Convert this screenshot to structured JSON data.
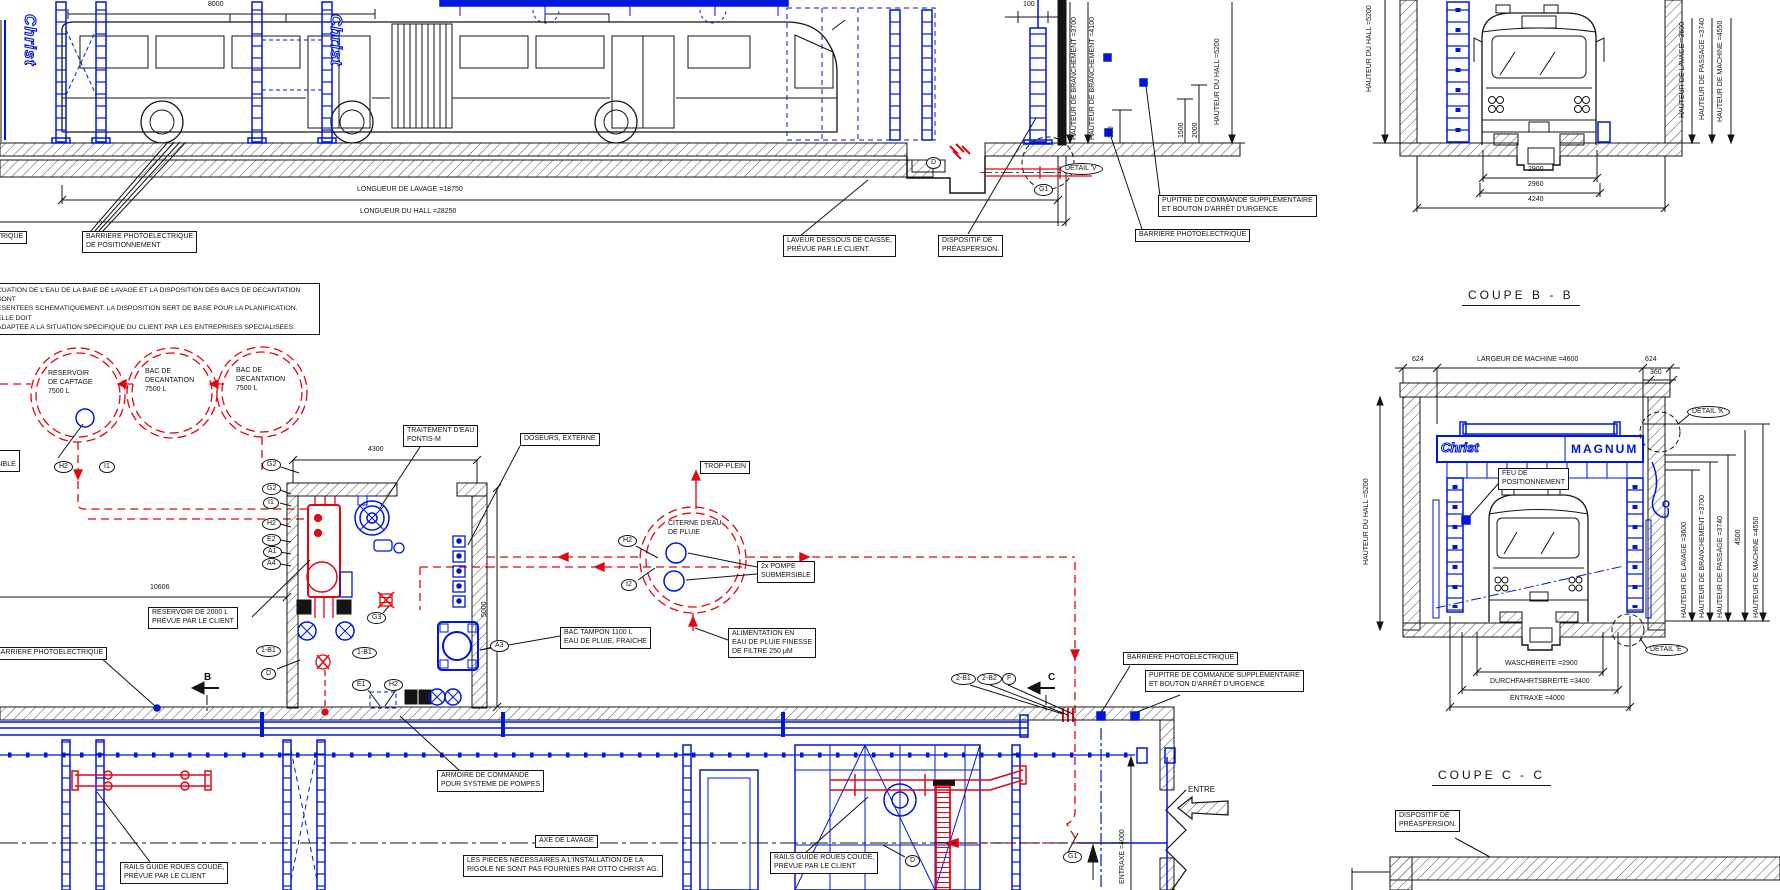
{
  "colors": {
    "blue": "#0016d9",
    "red": "#e30613",
    "black": "#141414"
  },
  "brand": {
    "christ": "Christ",
    "magnum": "MAGNUM"
  },
  "mk": {
    "h2": "H2",
    "i1": "I1",
    "i2": "I2",
    "g1": "G1",
    "g2": "G2",
    "g3": "G3",
    "e1": "E1",
    "e2": "E2",
    "a1": "A1",
    "a3": "A3",
    "a4": "A4",
    "d": "D",
    "f": "F",
    "b1": "1-B1",
    "b21": "2-B1",
    "b22": "2-B2",
    "b": "B",
    "c": "C"
  },
  "elevation": {
    "dim_8000": "8000",
    "dim_100": "100",
    "dim_300": "300",
    "dim_1500": "1500",
    "dim_2000": "2000",
    "longueur_lavage": "LONGUEUR DE LAVAGE =18750",
    "longueur_hall": "LONGUEUR DU HALL =28250",
    "h_branch_3700": "HAUTEUR DE BRANCHEMENT =3700",
    "h_branch_4100": "HAUTEUR DE BRANCHEMENT =4100",
    "h_hall_5200": "HAUTEUR DU HALL =5200",
    "detail_v": "DETAIL 'V'",
    "barriere_cut": "RE PHOTOELECTRIQUE",
    "barriere_pos": "BARRIERE PHOTOELECTRIQUE\nDE POSITIONNEMENT",
    "laveur": "LAVEUR DESSOUS DE CAISSE,\nPRÉVUE PAR LE CLIENT.",
    "preaspersion": "DISPOSITIF DE\nPRÉASPERSION.",
    "barriere": "BARRIERE PHOTOELECTRIQUE",
    "pupitre": "PUPITRE DE COMMANDE SUPPLÉMENTAIRE\nET BOUTON D'ARRÊT D'URGENCE"
  },
  "coupe_b": {
    "title": "COUPE B - B",
    "h_hall": "HAUTEUR DU HALL =5200",
    "h_lavage": "HAUTEUR DE LAVAGE =3600",
    "h_passage": "HAUTEUR DE PASSAGE =3740",
    "h_machine": "HAUTEUR DE MACHINE =4550",
    "d2900": "2900",
    "d2960": "2960",
    "d4240": "4240"
  },
  "coupe_c": {
    "title": "COUPE C - C",
    "d624": "624",
    "d360": "360",
    "d4500": "4500",
    "largeur": "LARGEUR DE MACHINE =4600",
    "h_hall": "HAUTEUR DU HALL =5200",
    "h_lavage": "HAUTEUR DE LAVAGE =3600",
    "h_branch": "HAUTEUR DE BRANCHEMENT =3700",
    "h_passage": "HAUTEUR DE PASSAGE =3740",
    "h_machine": "HAUTEUR DE MACHINE =4550",
    "feu": "FEU DE\nPOSITIONNEMENT",
    "detail_k": "DETAIL 'K'",
    "detail_e": "DETAIL 'E'",
    "waschbreite": "WASCHBREITE =2900",
    "durchfahrt": "DURCHFAHRTSBREITE =3400",
    "entraxe": "ENTRAXE =4000",
    "preaspersion": "DISPOSITIF DE\nPRÉASPERSION."
  },
  "plan": {
    "note": "CUATION DE L'EAU DE LA BAIE DE LAVAGE ET LA DISPOSITION DES BACS DE DECANTATION SONT\nESENTEES SCHEMATIQUEMENT. LA DISPOSITION SERT DE BASE POUR LA PLANIFICATION. ELLE DOIT\nADAPTEE A LA SITUATION SPECIFIQUE DU CLIENT PAR LES ENTREPRISES SPECIALISEES.",
    "tank1": "RESERVOIR\nDE CAPTAGE\n7500 L",
    "tank2": "BAC DE\nDECANTATION\n7500 L",
    "tank3": "BAC DE\nDECANTATION\n7500 L",
    "pompe_sub": "POMPE\nSUBMERSIBLE",
    "d10606": "10606",
    "d4300": "4300",
    "d5000": "5000",
    "traitement": "TRAITEMENT D'EAU\nFONTIS-M",
    "doseurs": "DOSEURS, EXTERNE",
    "trop_plein": "TROP-PLEIN",
    "citerne": "CITERNE D'EAU\nDE PLUIE",
    "pompe2x": "2x POMPE\nSUBMERSIBLE",
    "reservoir2000": "RESERVOIR DE 2000 L\nPRÉVUE PAR LE CLIENT",
    "bac_tampon": "BAC TAMPON 1100 L\nEAU DE PLUIE, FRAICHE",
    "alimentation": "ALIMENTATION EN\nEAU DE PLUIE FINESSE\nDE FILTRE 250 μM",
    "barriere_left": "BARRIERE PHOTOELECTRIQUE",
    "barriere": "BARRIERE PHOTOELECTRIQUE",
    "pupitre": "PUPITRE DE COMMANDE SUPPLÉMENTAIRE\nET BOUTON D'ARRÊT D'URGENCE"
  },
  "bottom": {
    "armoire": "ARMOIRE DE COMMANDE\nPOUR SYSTEME DE POMPES",
    "axe": "AXE DE LAVAGE",
    "rigole": "LES PIECES NECESSAIRES A L'INSTALLATION DE LA\nRIGOLE NE SONT PAS FOURNIES PAR OTTO CHRIST AG.",
    "rails1": "RAILS GUIDE ROUES COUDÉ,\nPRÉVUE PAR LE CLIENT",
    "rails2": "RAILS GUIDE ROUES COUDÉ,\nPRÉVUE PAR LE CLIENT",
    "entre": "ENTRE",
    "entraxe": "ENTRAXE =4000"
  }
}
